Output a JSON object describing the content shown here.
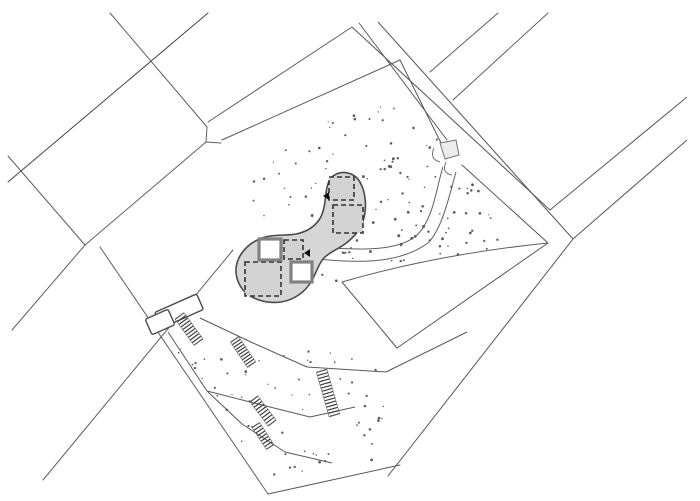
{
  "document": {
    "kind": "architectural-site-plan",
    "title": "Site plan line drawing",
    "canvas": {
      "width": 700,
      "height": 501,
      "background": "#ffffff"
    }
  },
  "palette": {
    "parcel_line": "#5f5f5f",
    "dark_line": "#454545",
    "boundary_line": "#565656",
    "terrace_line": "#5a5a5a",
    "blob_fill": "#d6d6d6",
    "blob_stroke": "#4a4a4a",
    "dashed_square_stroke": "#333333",
    "dashed_square_fill": "#d2d2d2",
    "wall_square_stroke": "#828282",
    "wall_square_fill": "#ffffff",
    "shed_stroke": "#4a4a4a",
    "shed_fill": "#ffffff",
    "stair_stroke": "#3d3d3d",
    "dot_color": "#5c5c5c",
    "marker_color": "#111111",
    "gate_fill": "#ececec",
    "gate_stroke": "#777777"
  },
  "geometry": {
    "field_segments": [
      [
        110,
        13,
        207,
        127
      ],
      [
        208,
        13,
        8,
        182
      ],
      [
        8,
        156,
        85,
        245
      ],
      [
        85,
        245,
        206,
        142
      ],
      [
        207,
        127,
        206,
        142
      ],
      [
        206,
        142,
        221,
        143
      ],
      [
        85,
        245,
        12,
        330
      ],
      [
        100,
        247,
        268,
        494
      ],
      [
        233,
        250,
        43,
        480
      ],
      [
        208,
        122,
        352,
        27
      ],
      [
        359,
        23,
        447,
        140
      ],
      [
        430,
        72,
        498,
        13
      ],
      [
        453,
        100,
        548,
        13
      ]
    ],
    "road_polylines": [
      [
        [
          352,
          27
        ],
        [
          550,
          210
        ],
        [
          687,
          97
        ]
      ],
      [
        [
          378,
          22
        ],
        [
          573,
          239
        ],
        [
          687,
          140
        ]
      ]
    ],
    "site_boundary_segments": [
      [
        222,
        140,
        400,
        60
      ],
      [
        400,
        60,
        441,
        143
      ],
      [
        462,
        165,
        548,
        243
      ],
      [
        548,
        243,
        397,
        348
      ],
      [
        397,
        348,
        342,
        282
      ],
      [
        573,
        239,
        388,
        476
      ],
      [
        268,
        494,
        400,
        465
      ]
    ],
    "terrace_polylines": [
      [
        [
          200,
          318
        ],
        [
          253,
          343
        ],
        [
          307,
          367
        ],
        [
          386,
          372
        ]
      ],
      [
        [
          386,
          372
        ],
        [
          467,
          332
        ]
      ],
      [
        [
          168,
          332
        ],
        [
          207,
          391
        ]
      ],
      [
        [
          207,
          391
        ],
        [
          258,
          404
        ],
        [
          310,
          417
        ],
        [
          355,
          407
        ]
      ],
      [
        [
          207,
          391
        ],
        [
          242,
          424
        ],
        [
          285,
          452
        ],
        [
          332,
          463
        ]
      ]
    ],
    "curves": [
      {
        "name": "parcel-top-edge",
        "d": "M342,282 C390,268 460,252 548,243",
        "w": 1
      },
      {
        "name": "driveway-edge",
        "d": "M316,247 C360,250 398,252 417,235 C434,219 437,184 443,167",
        "w": 1
      },
      {
        "name": "driveway-edge",
        "d": "M318,259 C365,264 402,262 428,243 C443,228 450,192 456,172",
        "w": 1
      }
    ],
    "site_blob": "M333,176 C343,169 356,173 361,184 C366,194 367,209 363,221 C360,231 353,238 345,244 C337,250 329,252 323,259 C318,265 316,274 311,282 C305,292 294,300 281,302 C266,304 251,299 243,290 C236,281 234,270 238,260 C242,250 251,242 262,238 C273,234 285,236 296,234 C306,232 314,227 319,220 C324,213 325,202 326,193 C327,185 329,179 333,176 Z",
    "dashed_squares": [
      [
        329,
        177,
        25,
        23
      ],
      [
        333,
        205,
        30,
        28
      ],
      [
        284,
        240,
        19,
        19
      ],
      [
        245,
        262,
        36,
        34
      ]
    ],
    "wall_squares": [
      [
        259,
        239,
        22,
        21
      ],
      [
        291,
        262,
        21,
        20
      ]
    ],
    "direction_markers": [
      [
        329,
        192,
        329,
        200,
        323,
        196
      ],
      [
        310,
        249,
        310,
        257,
        304,
        253
      ]
    ],
    "sheds": [
      [
        179,
        311,
        46,
        17,
        -24
      ],
      [
        160,
        322,
        25,
        17,
        -24
      ]
    ],
    "stairs": [
      [
        189,
        329,
        32,
        11,
        54,
        10
      ],
      [
        243,
        352,
        30,
        10,
        56,
        10
      ],
      [
        328,
        393,
        46,
        11,
        74,
        14
      ],
      [
        263,
        411,
        30,
        10,
        53,
        9
      ],
      [
        263,
        436,
        26,
        9,
        57,
        8
      ]
    ],
    "entrance_gate": {
      "square": "M440,143 L456,140 L459,155 L445,159 Z",
      "arcs": [
        "M434,148 Q429,159 440,162",
        "M446,162 Q441,173 452,175"
      ]
    },
    "dot_regions": [
      {
        "name": "upper-planting-dots",
        "polygon": [
          [
            232,
            182
          ],
          [
            360,
            100
          ],
          [
            402,
            66
          ],
          [
            438,
            138
          ],
          [
            460,
            166
          ],
          [
            540,
            240
          ],
          [
            440,
            258
          ],
          [
            344,
            280
          ],
          [
            312,
            298
          ],
          [
            260,
            302
          ],
          [
            232,
            240
          ]
        ],
        "exclude_circles": [
          [
            276,
            268,
            44
          ],
          [
            347,
            203,
            29
          ],
          [
            328,
            232,
            20
          ]
        ],
        "count": 115,
        "seed": 7,
        "r_min": 0.6,
        "r_max": 1.5
      },
      {
        "name": "lower-planting-dots",
        "polygon": [
          [
            170,
            344
          ],
          [
            385,
            355
          ],
          [
            385,
            462
          ],
          [
            272,
            486
          ]
        ],
        "exclude_circles": [
          [
            189,
            329,
            18
          ],
          [
            243,
            352,
            16
          ],
          [
            328,
            393,
            18
          ],
          [
            263,
            411,
            14
          ],
          [
            263,
            436,
            12
          ]
        ],
        "count": 62,
        "seed": 13,
        "r_min": 0.6,
        "r_max": 1.4
      }
    ]
  }
}
